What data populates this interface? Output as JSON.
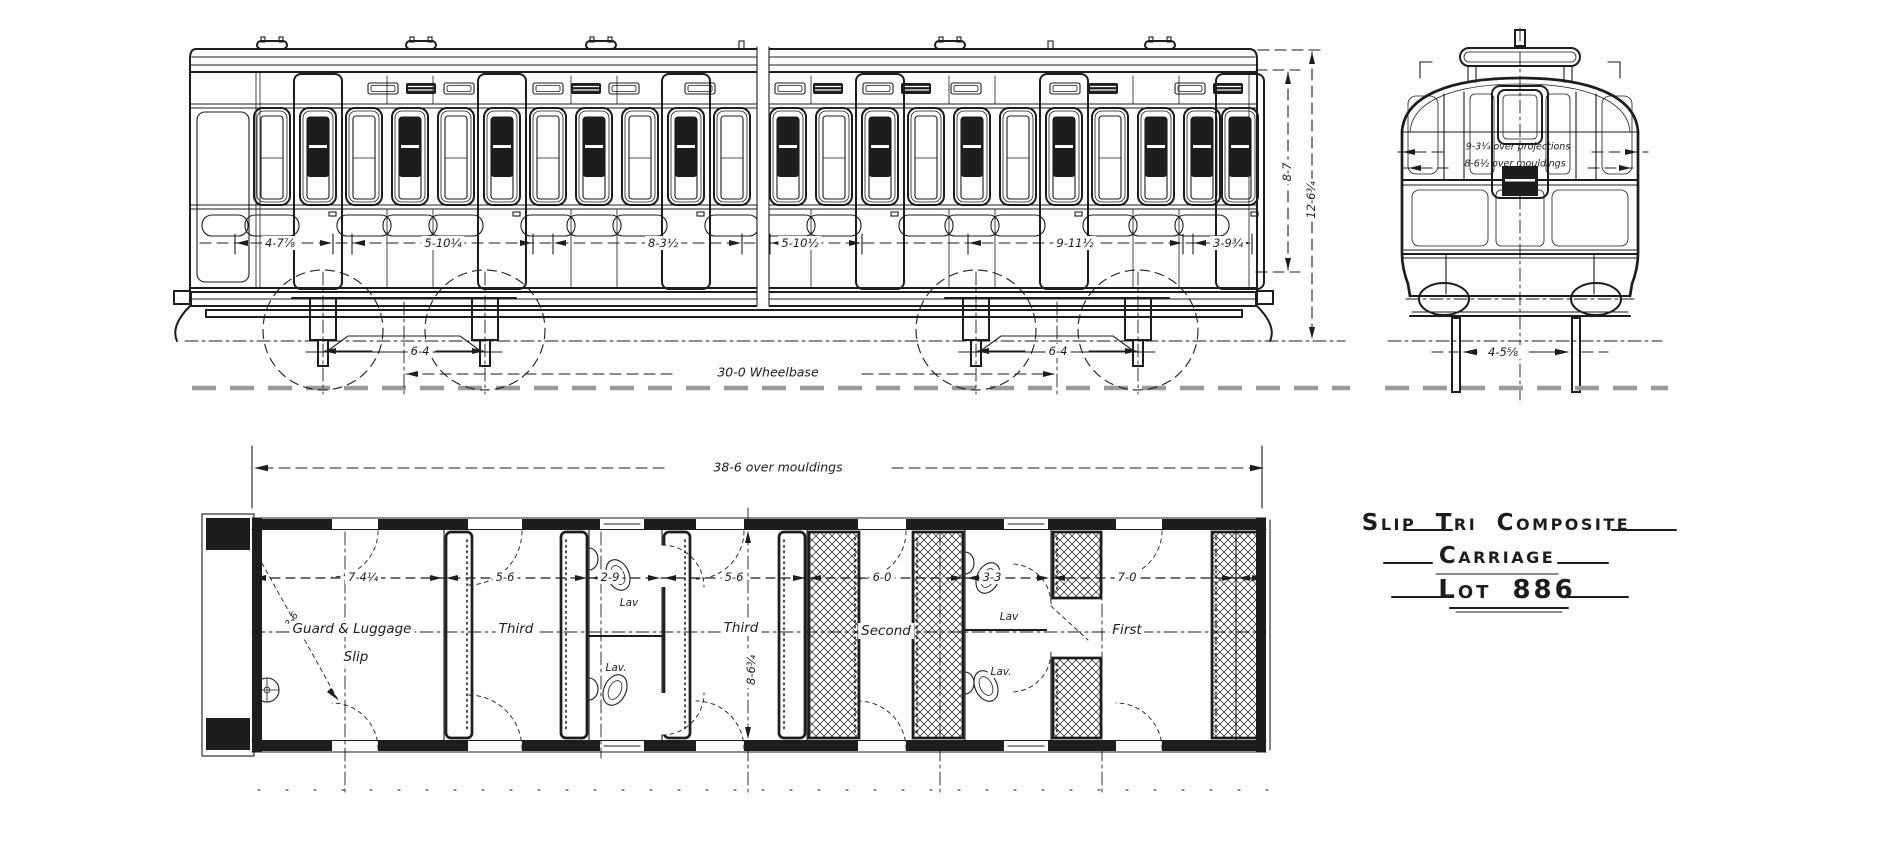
{
  "drawing": {
    "title_block": {
      "line1": "Slip Tri Composite",
      "line2": "Carriage",
      "line3": "Lot 886"
    },
    "side_elevation": {
      "panel_dims": [
        "4-7⅞",
        "5-10¼",
        "8-3½",
        "5-10½",
        "9-11½",
        "3-9¾"
      ],
      "bogie_wheelbase_left": "6-4",
      "bogie_wheelbase_right": "6-4",
      "wheelbase_label": "30-0 Wheelbase",
      "height_to_cantrail": "8-7",
      "height_overall": "12-6¾"
    },
    "end_elevation": {
      "width_over_projections": "9-3¼ over projections",
      "width_over_mouldings": "8-6½ over mouldings",
      "underframe_width": "4-5⅝"
    },
    "floor_plan": {
      "length_overall": "38-6 over mouldings",
      "body_width": "8-6¾",
      "guard_door_dim": "3-6",
      "dims": [
        "7-4¼",
        "5-6",
        "2-9",
        "5-6",
        "6-0",
        "3-3",
        "7-0"
      ],
      "labels": {
        "guard": "Guard & Luggage",
        "slip": "Slip",
        "third_a": "Third",
        "lav_a_upper": "Lav",
        "lav_a_lower": "Lav.",
        "third_b": "Third",
        "second": "Second",
        "lav_b_upper": "Lav",
        "lav_b_lower": "Lav.",
        "first": "First"
      }
    }
  },
  "colors": {
    "ink": "#1d1d1d",
    "paper": "#fdfdfc",
    "ground": "#9b9b9b"
  }
}
